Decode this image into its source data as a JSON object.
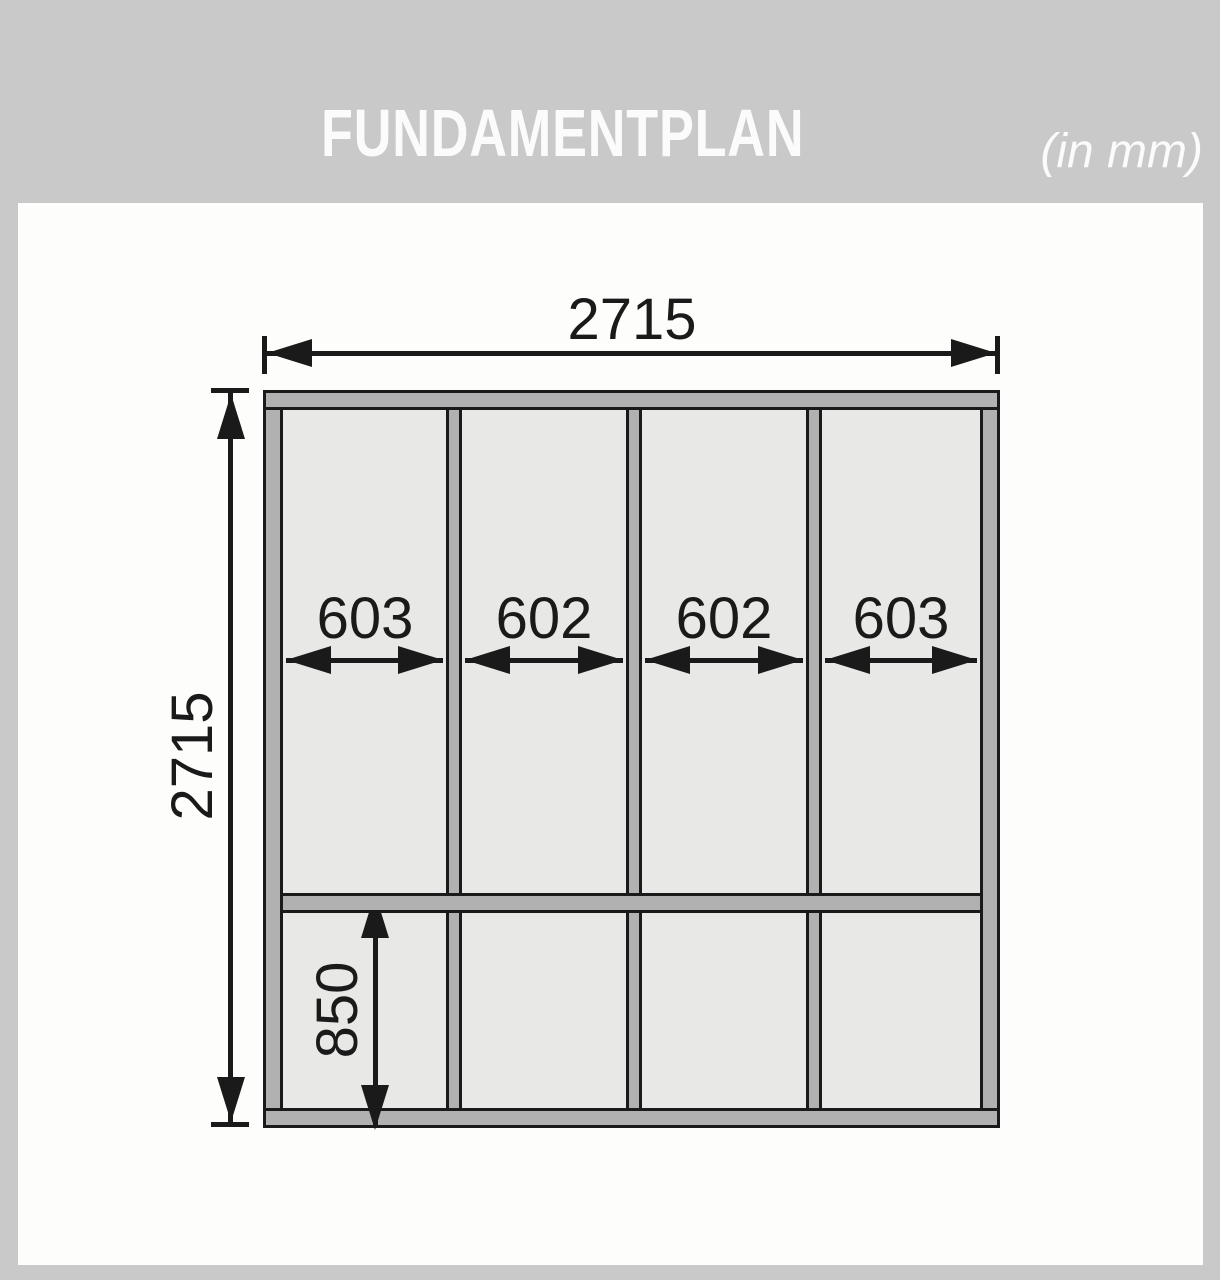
{
  "header": {
    "title": "FUNDAMENTPLAN",
    "unit_note": "(in mm)"
  },
  "drawing": {
    "type": "foundation-plan",
    "overall_width_mm": "2715",
    "overall_height_mm": "2715",
    "bay_widths_mm": [
      "603",
      "602",
      "602",
      "603"
    ],
    "bottom_row_height_mm": "850"
  },
  "colors": {
    "header_and_border": "#c9c9c9",
    "sheet_background": "#fdfdfb",
    "panel_fill": "#e8e8e6",
    "beam_fill": "#b1b1b1",
    "line_ink": "#1a1a1a",
    "header_text": "#fbfbfb"
  }
}
